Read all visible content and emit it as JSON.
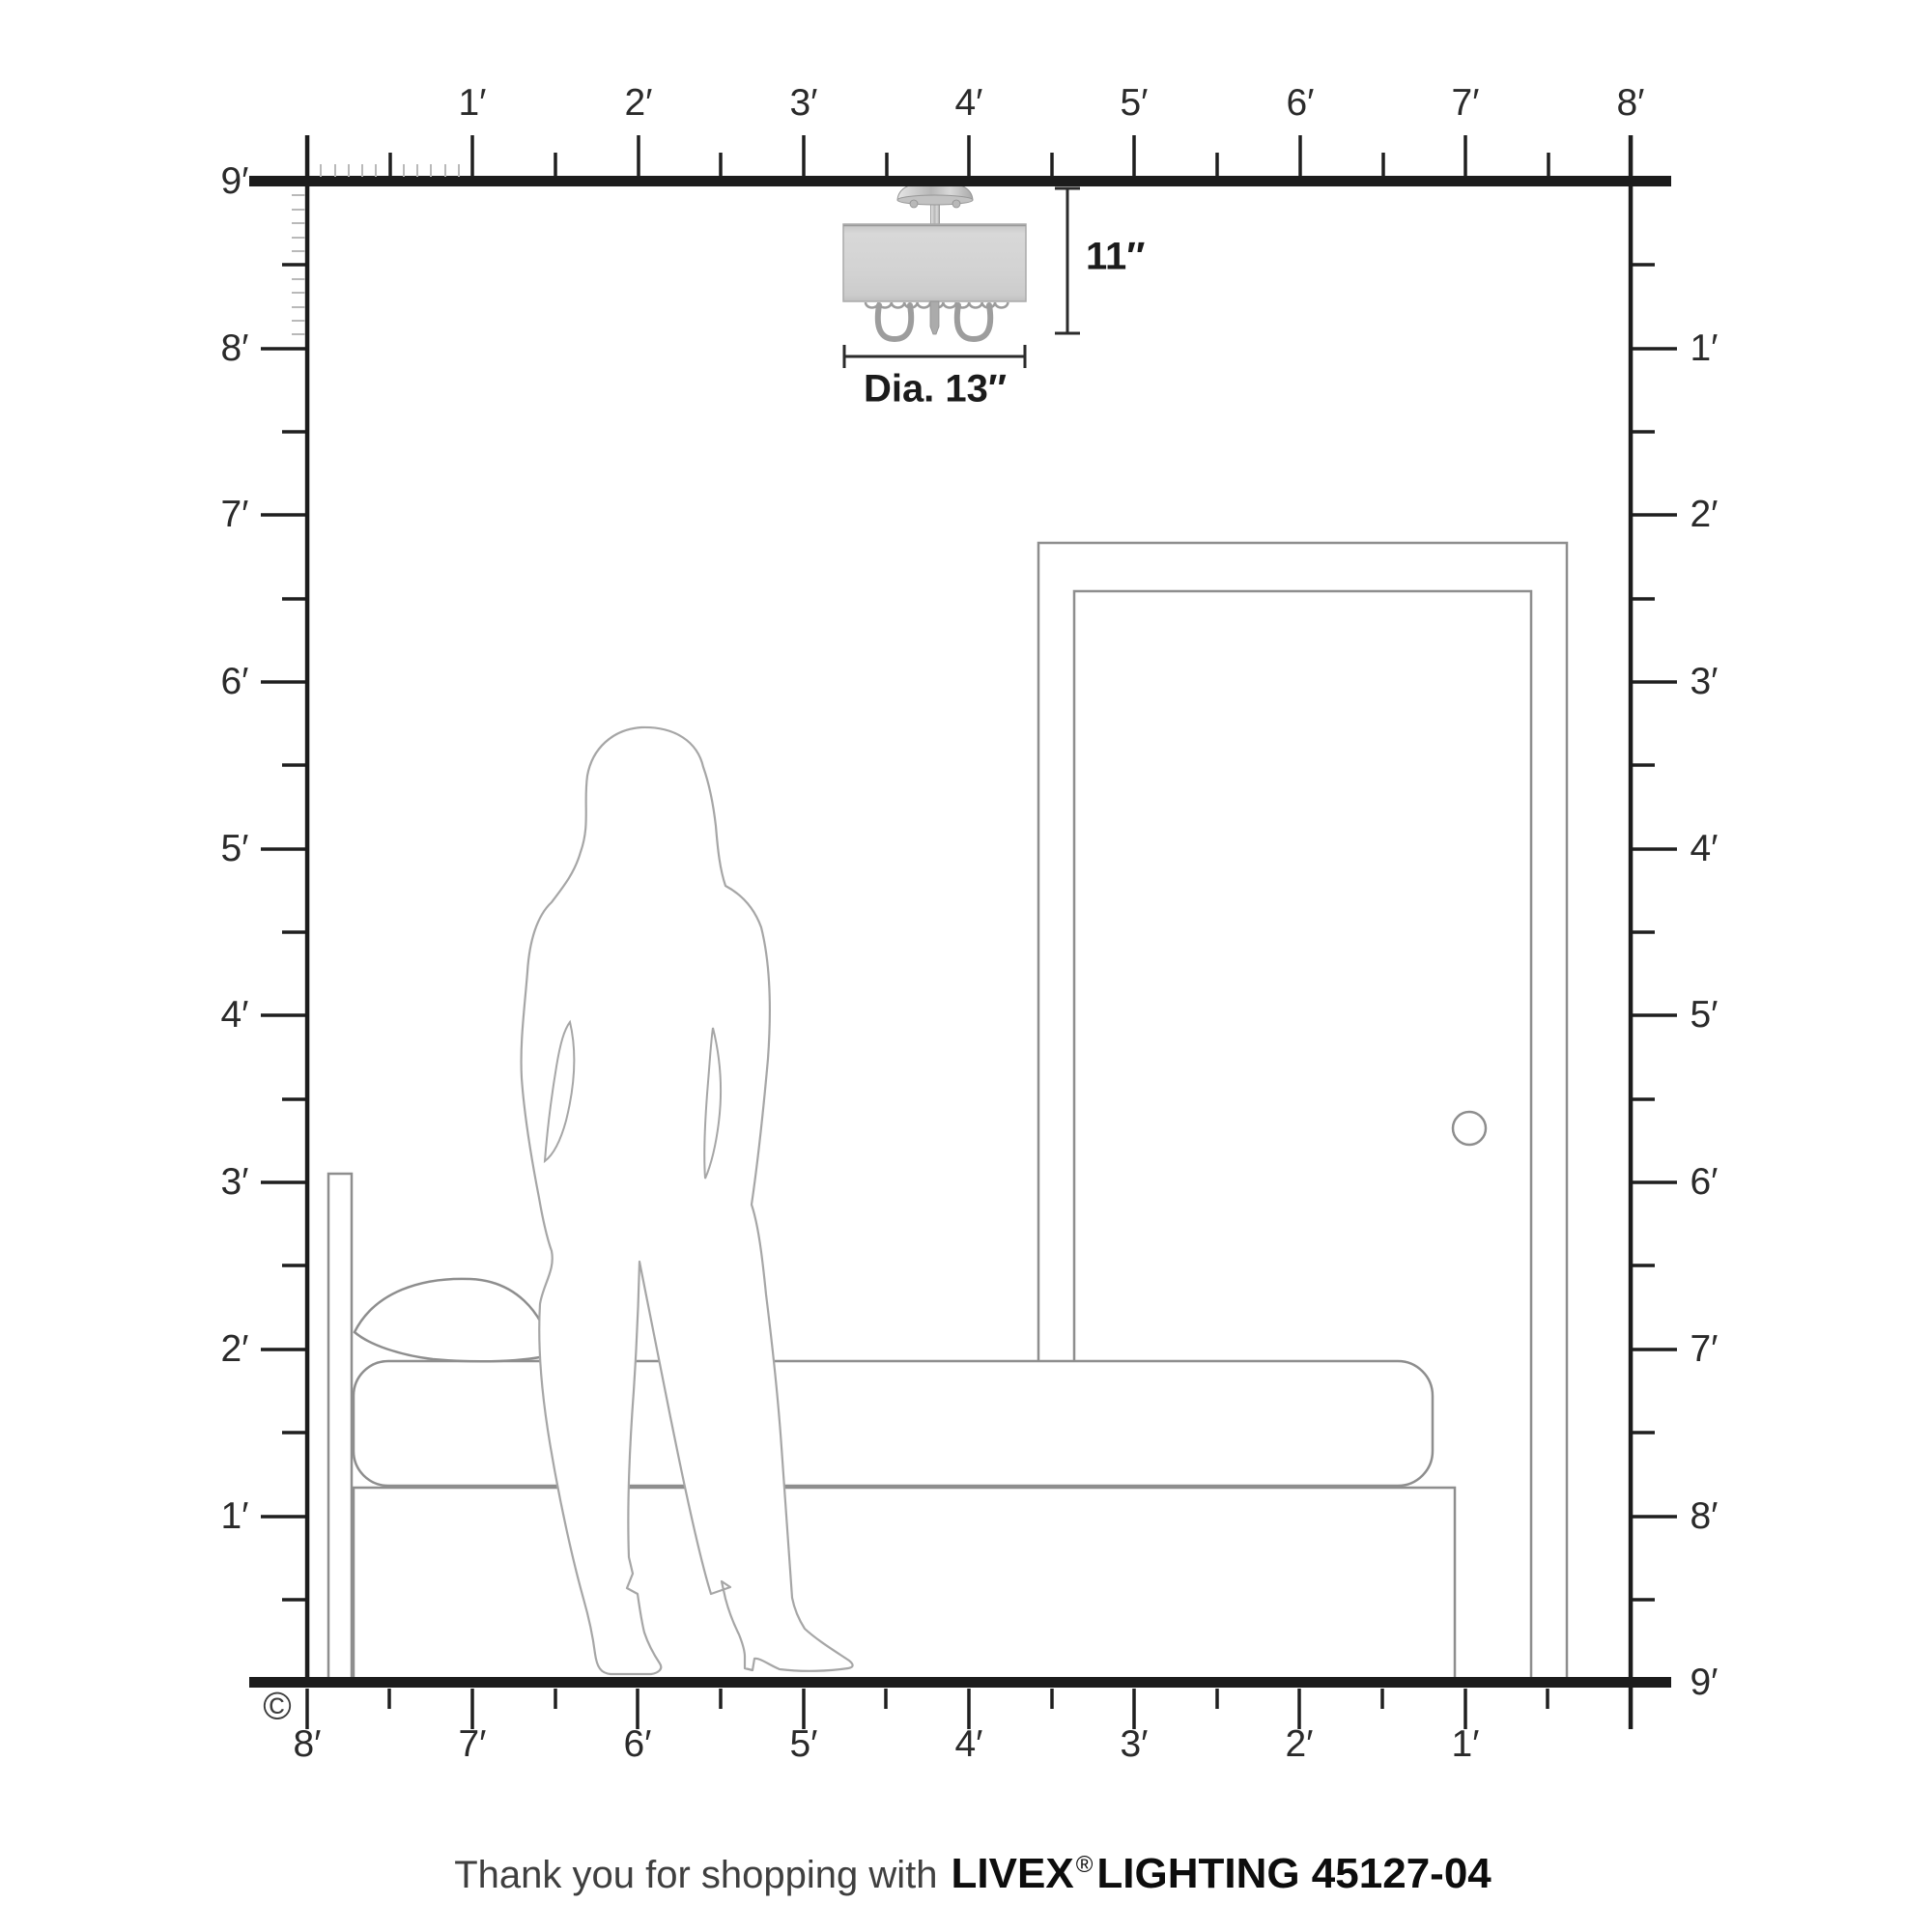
{
  "rulers": {
    "top": [
      "1′",
      "2′",
      "3′",
      "4′",
      "5′",
      "6′",
      "7′",
      "8′"
    ],
    "left": [
      "9′",
      "8′",
      "7′",
      "6′",
      "5′",
      "4′",
      "3′",
      "2′",
      "1′"
    ],
    "right": [
      "1′",
      "2′",
      "3′",
      "4′",
      "5′",
      "6′",
      "7′",
      "8′",
      "9′"
    ],
    "bottom": [
      "8′",
      "7′",
      "6′",
      "5′",
      "4′",
      "3′",
      "2′",
      "1′"
    ]
  },
  "fixture": {
    "height_label": "11″",
    "diameter_label": "Dia. 13″"
  },
  "copyright": "©",
  "footer": {
    "prefix": "Thank you for shopping with",
    "brand": "LIVEX",
    "registered": "®",
    "suffix": "LIGHTING 45127-04"
  },
  "colors": {
    "structure_line": "#1c1c1c",
    "tick": "#1f1f1f",
    "inch_tick": "#b9b9b9",
    "furniture_outline": "#8e8e8e",
    "figure_outline": "#a6a6a6",
    "shade_fill": "#d2d2d2",
    "label_text": "#2a2a2a"
  }
}
